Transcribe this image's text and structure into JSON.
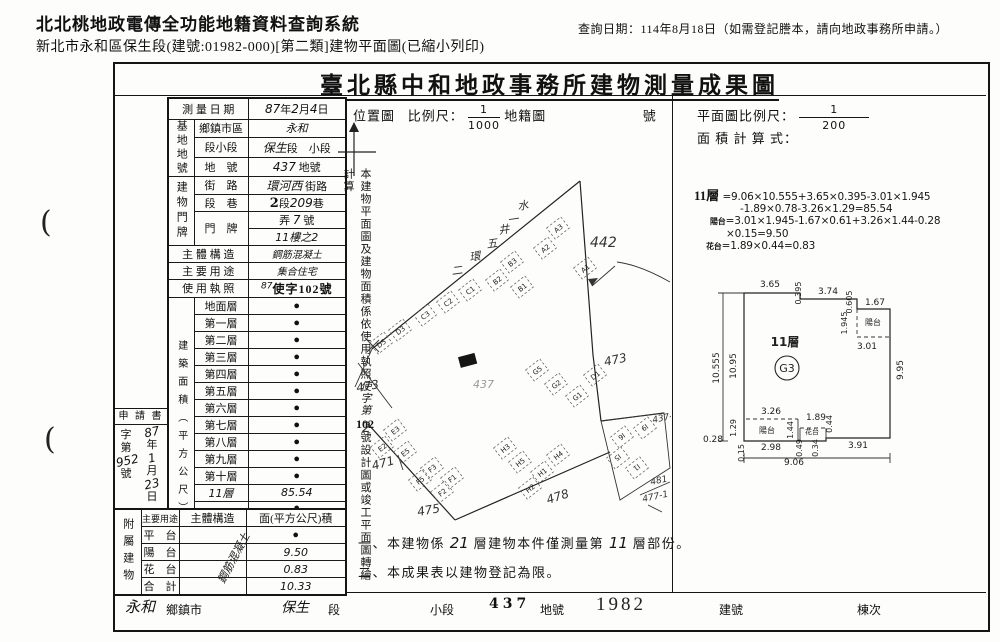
{
  "header": {
    "system_title": "北北桃地政電傳全功能地籍資料查詢系統",
    "query_date": "查詢日期：114年8月18日（如需登記謄本，請向地政事務所申請。）",
    "subtitle": "新北市永和區保生段(建號:01982-000)[第二類]建物平面圖(已縮小列印)",
    "punch_mark": "("
  },
  "doc_title": "臺北縣中和地政事務所建物測量成果圖",
  "lt": {
    "survey_l": "測 量 日 期",
    "sv1": "87",
    "sv2": "年",
    "sv3": "2",
    "sv4": "月",
    "sv5": "4",
    "sv6": "日",
    "g_site": "基地地號",
    "r1l": "鄉鎮市區",
    "r1v": "永和",
    "r2l": "段小段",
    "r2hw": "保生",
    "r2p": "段　小段",
    "r3l": "地　號",
    "r3hw": "437",
    "r3p": "地號",
    "g_addr": "建物門牌",
    "r4l": "街　路",
    "r4hw": "環河西",
    "r4p": "街路",
    "r5l": "段　巷",
    "r5s": "2",
    "r5p1": "段",
    "r5hw": "209",
    "r5p2": "巷",
    "r6l": "門　牌",
    "r6p1": "弄",
    "r6hw1": "7",
    "r6p2": "號",
    "r6hw2": "11樓之2",
    "r7l": "主 體 構 造",
    "r7v": "鋼筋混凝土",
    "r8l": "主 要 用 途",
    "r8v": "集合住宅",
    "r9l": "使 用 執 照",
    "r9sup": "87",
    "r9v": "使字102號",
    "g_area": "建築面積（平方公尺）",
    "floors": [
      {
        "l": "地面層",
        "v": "●"
      },
      {
        "l": "第一層",
        "v": "●"
      },
      {
        "l": "第二層",
        "v": "●"
      },
      {
        "l": "第三層",
        "v": "●"
      },
      {
        "l": "第四層",
        "v": "●"
      },
      {
        "l": "第五層",
        "v": "●"
      },
      {
        "l": "第六層",
        "v": "●"
      },
      {
        "l": "第七層",
        "v": "●"
      },
      {
        "l": "第八層",
        "v": "●"
      },
      {
        "l": "第九層",
        "v": "●"
      },
      {
        "l": "第十層",
        "v": "●"
      },
      {
        "l": "11層",
        "lh": 1,
        "v": "85.54",
        "vh": 1
      },
      {
        "l": "",
        "v": "●"
      },
      {
        "l": "",
        "v": "●"
      },
      {
        "l": "地下層",
        "v": "●"
      },
      {
        "l": "騎　樓",
        "v": "●"
      }
    ],
    "total_l": "合　　計",
    "total_v": "85.54",
    "app": {
      "title": "申 請 書",
      "col1": [
        {
          "t": "字"
        },
        {
          "t": "第"
        },
        {
          "t": "952",
          "hw": 1
        },
        {
          "t": "號"
        }
      ],
      "col2": [
        {
          "t": "87",
          "hw": 1
        },
        {
          "t": "年"
        },
        {
          "t": "1",
          "hw": 1
        },
        {
          "t": "月"
        },
        {
          "t": "23",
          "hw": 1
        },
        {
          "t": "日"
        }
      ]
    },
    "annex": {
      "g": "附屬建物",
      "h1": "主要用途",
      "h2": "主體構造",
      "h3": "面(平方公尺)積",
      "diag": "鋼筋混凝土",
      "rows": [
        {
          "l": "平　台",
          "v": "●"
        },
        {
          "l": "陽　台",
          "v": "9.50"
        },
        {
          "l": "花　台",
          "v": "0.83"
        },
        {
          "l": "合　計",
          "v": "10.33"
        }
      ]
    }
  },
  "mid": {
    "loc": "位置圖",
    "scale_lbl": "比例尺：",
    "scale_num": "1",
    "scale_den": "1000",
    "cad": "地籍圖",
    "no": "號",
    "vstrip_a": "本建物平面圖及建物面積係依使用執照",
    "vstrip_hw": "使字第",
    "vstrip_num": "102",
    "vstrip_b": "號設計圖或竣工平面圖轉繪計算",
    "notes": {
      "n1a": "一、本建物係",
      "n1hw1": "21",
      "n1b": "層建物本件僅測量第",
      "n1hw2": "11",
      "n1c": "層部份。",
      "n2": "二、本成果表以建物登記為限。"
    }
  },
  "right": {
    "scale_lbl": "平面圖比例尺：",
    "num": "1",
    "den": "200",
    "calc": "面 積 計 算 式："
  },
  "formula": {
    "f0": "11層",
    "f1": "=9.06×10.555+3.65×0.395-3.01×1.945",
    "f2": "-1.89×0.78-3.26×1.29=85.54",
    "f3a": "陽台",
    "f3b": "=3.01×1.945-1.67×0.61+3.26×1.44-0.28",
    "f4": "×0.15=9.50",
    "f5a": "花台",
    "f5b": "=1.89×0.44=0.83"
  },
  "site_plan": {
    "lots": [
      {
        "t": "442",
        "x": 245,
        "y": 147,
        "s": 14,
        "cls": "hw"
      },
      {
        "t": "473",
        "x": 12,
        "y": 292,
        "s": 12,
        "cls": "hw",
        "r": -10
      },
      {
        "t": "2",
        "x": 17,
        "y": 332,
        "s": 14,
        "cls": "hw"
      },
      {
        "t": "471",
        "x": 28,
        "y": 370,
        "s": 12,
        "cls": "hw",
        "r": -15
      },
      {
        "t": "475",
        "x": 73,
        "y": 416,
        "s": 12,
        "cls": "hw",
        "r": -10
      },
      {
        "t": "478",
        "x": 203,
        "y": 404,
        "s": 12,
        "cls": "hw",
        "r": -18
      },
      {
        "t": "473",
        "x": 260,
        "y": 266,
        "s": 12,
        "cls": "hw",
        "r": -12
      },
      {
        "t": "437-1",
        "x": 308,
        "y": 323,
        "s": 9,
        "cls": "hw",
        "r": -12
      },
      {
        "t": "481",
        "x": 306,
        "y": 385,
        "s": 9,
        "cls": "hw",
        "r": -12
      },
      {
        "t": "477-1",
        "x": 298,
        "y": 402,
        "s": 9,
        "cls": "hw",
        "r": -12
      },
      {
        "t": "437",
        "x": 128,
        "y": 288,
        "s": 11,
        "cls": "hwf"
      }
    ],
    "road_chars": [
      {
        "t": "水",
        "x": 173,
        "y": 110
      },
      {
        "t": "一",
        "x": 163,
        "y": 124
      },
      {
        "t": "井",
        "x": 154,
        "y": 134
      },
      {
        "t": "五",
        "x": 142,
        "y": 148
      },
      {
        "t": "環",
        "x": 125,
        "y": 161
      },
      {
        "t": "二",
        "x": 107,
        "y": 175
      }
    ],
    "units": [
      {
        "t": "A3",
        "x": 213,
        "y": 128
      },
      {
        "t": "A2",
        "x": 200,
        "y": 148
      },
      {
        "t": "A1",
        "x": 240,
        "y": 168
      },
      {
        "t": "B3",
        "x": 167,
        "y": 162
      },
      {
        "t": "B2",
        "x": 152,
        "y": 180
      },
      {
        "t": "B1",
        "x": 177,
        "y": 187
      },
      {
        "t": "C1",
        "x": 125,
        "y": 190
      },
      {
        "t": "C2",
        "x": 103,
        "y": 202
      },
      {
        "t": "C3",
        "x": 80,
        "y": 215
      },
      {
        "t": "D3",
        "x": 55,
        "y": 230
      },
      {
        "t": "D5",
        "x": 36,
        "y": 243
      },
      {
        "t": "E3",
        "x": 50,
        "y": 330
      },
      {
        "t": "E2",
        "x": 37,
        "y": 347
      },
      {
        "t": "E5",
        "x": 60,
        "y": 352
      },
      {
        "t": "F3",
        "x": 87,
        "y": 368
      },
      {
        "t": "F1",
        "x": 107,
        "y": 378
      },
      {
        "t": "F2",
        "x": 97,
        "y": 392
      },
      {
        "t": "F5",
        "x": 75,
        "y": 380
      },
      {
        "t": "G5",
        "x": 192,
        "y": 270
      },
      {
        "t": "G2",
        "x": 211,
        "y": 284
      },
      {
        "t": "G1",
        "x": 232,
        "y": 296
      },
      {
        "t": "D1",
        "x": 250,
        "y": 275
      },
      {
        "t": "H3",
        "x": 160,
        "y": 348
      },
      {
        "t": "H5",
        "x": 175,
        "y": 362
      },
      {
        "t": "H1",
        "x": 197,
        "y": 372
      },
      {
        "t": "H2",
        "x": 185,
        "y": 388
      },
      {
        "t": "H4",
        "x": 213,
        "y": 355
      },
      {
        "t": "I6",
        "x": 277,
        "y": 337,
        "r": 142
      },
      {
        "t": "I9",
        "x": 300,
        "y": 328,
        "r": 142
      },
      {
        "t": "I1",
        "x": 292,
        "y": 368,
        "r": 142
      },
      {
        "t": "I5",
        "x": 273,
        "y": 358,
        "r": 142
      }
    ]
  },
  "floor_plan": {
    "unit_label": "11層",
    "unit_circle": "G3",
    "dims": [
      {
        "t": "3.65",
        "x": 80,
        "y": 31
      },
      {
        "t": "0.395",
        "x": 111,
        "y": 37,
        "r": -90,
        "s": 8
      },
      {
        "t": "3.74",
        "x": 138,
        "y": 38
      },
      {
        "t": "0.605",
        "x": 162,
        "y": 46,
        "r": -90,
        "s": 8
      },
      {
        "t": "1.67",
        "x": 185,
        "y": 49
      },
      {
        "t": "1.945",
        "x": 157,
        "y": 67,
        "r": -90,
        "s": 8
      },
      {
        "t": "陽台",
        "x": 183,
        "y": 69,
        "s": 8,
        "cjk": 1
      },
      {
        "t": "3.01",
        "x": 177,
        "y": 93
      },
      {
        "t": "10.555",
        "x": 29,
        "y": 112,
        "r": -90
      },
      {
        "t": "10.95",
        "x": 46,
        "y": 110,
        "r": -90
      },
      {
        "t": "9.95",
        "x": 213,
        "y": 114,
        "r": -90
      },
      {
        "t": "3.26",
        "x": 81,
        "y": 158
      },
      {
        "t": "1.29",
        "x": 46,
        "y": 172,
        "r": -90,
        "s": 8
      },
      {
        "t": "陽台",
        "x": 77,
        "y": 177,
        "s": 8,
        "cjk": 1
      },
      {
        "t": "1.44",
        "x": 103,
        "y": 174,
        "r": -90,
        "s": 8
      },
      {
        "t": "1.89",
        "x": 126,
        "y": 164
      },
      {
        "t": "花台",
        "x": 122,
        "y": 178,
        "s": 7,
        "cjk": 1
      },
      {
        "t": "0.44",
        "x": 142,
        "y": 168,
        "r": -90,
        "s": 8
      },
      {
        "t": "0.49",
        "x": 112,
        "y": 192,
        "r": -90,
        "s": 8
      },
      {
        "t": "0.34",
        "x": 128,
        "y": 192,
        "r": -90,
        "s": 8
      },
      {
        "t": "0.28",
        "x": 23,
        "y": 186,
        "s": 9
      },
      {
        "t": "0.15",
        "x": 54,
        "y": 197,
        "r": -90,
        "s": 8
      },
      {
        "t": "2.98",
        "x": 81,
        "y": 194
      },
      {
        "t": "3.91",
        "x": 168,
        "y": 192
      },
      {
        "t": "9.06",
        "x": 104,
        "y": 209
      }
    ]
  },
  "bottom": {
    "items": [
      {
        "t": "永和",
        "x": 125,
        "y": 596,
        "s": 15,
        "cls": "hw"
      },
      {
        "t": "鄉鎮市",
        "x": 166,
        "y": 601,
        "s": 12
      },
      {
        "t": "保生",
        "x": 281,
        "y": 597,
        "s": 14,
        "cls": "hw"
      },
      {
        "t": "段",
        "x": 328,
        "y": 601,
        "s": 12
      },
      {
        "t": "小段",
        "x": 430,
        "y": 601,
        "s": 12
      },
      {
        "t": "437",
        "x": 489,
        "y": 596,
        "s": 14,
        "cls": "stamp"
      },
      {
        "t": "地號",
        "x": 540,
        "y": 601,
        "s": 12
      },
      {
        "t": "1982",
        "x": 596,
        "y": 594,
        "s": 19,
        "cls": "stamp1982"
      },
      {
        "t": "建號",
        "x": 719,
        "y": 601,
        "s": 12
      },
      {
        "t": "棟次",
        "x": 857,
        "y": 601,
        "s": 12
      }
    ]
  }
}
